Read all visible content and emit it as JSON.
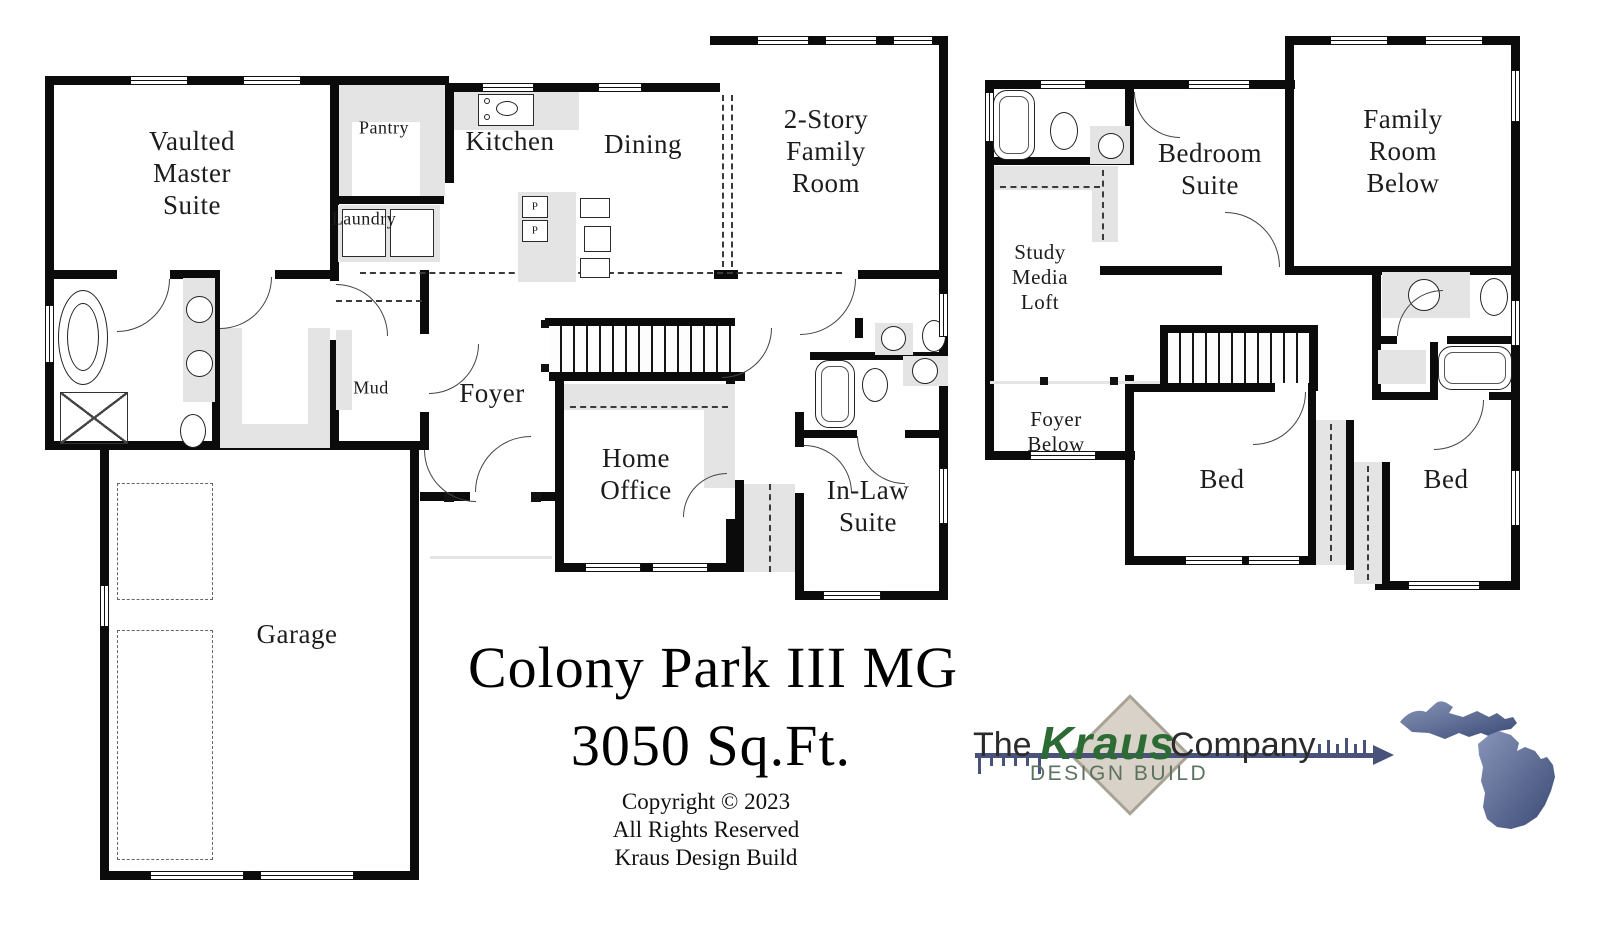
{
  "title_block": {
    "plan_name": "Colony Park III MG",
    "area": "3050 Sq.Ft.",
    "copyright_line": "Copyright © 2023",
    "rights_line": "All Rights Reserved",
    "company_line": "Kraus Design Build"
  },
  "logo": {
    "prefix": "The",
    "brand": "Kraus",
    "suffix": "Company",
    "tagline": "DESIGN BUILD",
    "brand_color": "#2d6b35",
    "tagline_color": "#5c7260",
    "ruler_color": "#49527a",
    "diamond_fill": "#d8d2c9",
    "diamond_border": "#a9a396",
    "michigan_light": "#8894b8",
    "michigan_dark": "#3a4a75"
  },
  "floor1": {
    "vaulted_master_suite": "Vaulted\nMaster\nSuite",
    "pantry": "Pantry",
    "kitchen": "Kitchen",
    "dining": "Dining",
    "two_story_family_room": "2-Story\nFamily\nRoom",
    "laundry": "Laundry",
    "mud": "Mud",
    "foyer": "Foyer",
    "home_office": "Home\nOffice",
    "in_law_suite": "In-Law\nSuite",
    "garage": "Garage",
    "island_cabinet_1": "P",
    "island_cabinet_2": "P"
  },
  "floor2": {
    "bedroom_suite": "Bedroom\nSuite",
    "family_room_below": "Family\nRoom\nBelow",
    "study_media_loft": "Study\nMedia\nLoft",
    "foyer_below": "Foyer\nBelow",
    "bed_left": "Bed",
    "bed_right": "Bed"
  }
}
